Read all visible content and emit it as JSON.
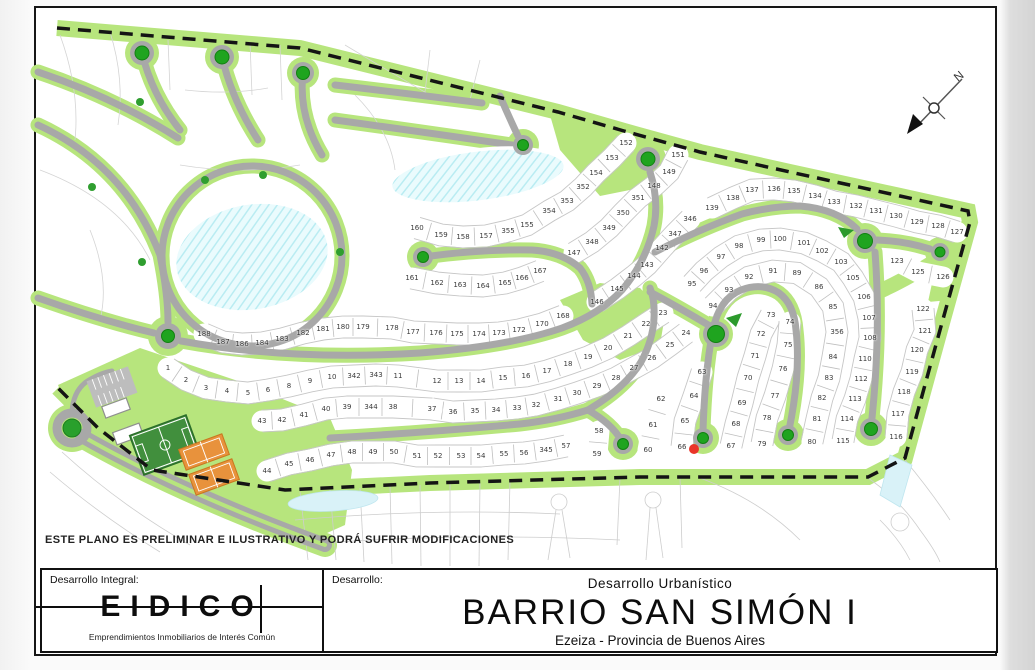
{
  "disclaimer": "ESTE PLANO ES PRELIMINAR E ILUSTRATIVO Y PODRÁ SUFRIR MODIFICACIONES",
  "title_block": {
    "left_label": "Desarrollo Integral:",
    "logo_text": "EIDICO",
    "logo_subtitle": "Emprendimientos Inmobiliarios de Interés Común",
    "dev_label": "Desarrollo:",
    "dev_type": "Desarrollo  Urbanístico",
    "project_name": "BARRIO SAN SIMÓN I",
    "location": "Ezeiza - Provincia de Buenos Aires"
  },
  "map": {
    "north_label": "N",
    "red_dot": {
      "x": 694,
      "y": 449,
      "color": "#e93428"
    },
    "colors": {
      "green": "#b7e57d",
      "road": "#a8a8a8",
      "tree": "#1fa41f",
      "lake": "#eafbfd",
      "court_orange": "#e8923c",
      "field_green": "#418f3d"
    },
    "lots": [
      [
        "1",
        168,
        368
      ],
      [
        "2",
        186,
        380
      ],
      [
        "3",
        206,
        388
      ],
      [
        "4",
        227,
        391
      ],
      [
        "5",
        248,
        393
      ],
      [
        "6",
        268,
        390
      ],
      [
        "8",
        289,
        386
      ],
      [
        "9",
        310,
        381
      ],
      [
        "10",
        332,
        377
      ],
      [
        "342",
        354,
        376
      ],
      [
        "343",
        376,
        375
      ],
      [
        "11",
        398,
        376
      ],
      [
        "12",
        437,
        381
      ],
      [
        "13",
        459,
        381
      ],
      [
        "14",
        481,
        381
      ],
      [
        "15",
        503,
        378
      ],
      [
        "16",
        526,
        376
      ],
      [
        "17",
        547,
        371
      ],
      [
        "18",
        568,
        364
      ],
      [
        "19",
        588,
        357
      ],
      [
        "20",
        608,
        348
      ],
      [
        "21",
        628,
        336
      ],
      [
        "22",
        646,
        324
      ],
      [
        "23",
        663,
        313
      ],
      [
        "24",
        686,
        333
      ],
      [
        "25",
        670,
        345
      ],
      [
        "26",
        652,
        358
      ],
      [
        "27",
        634,
        368
      ],
      [
        "28",
        616,
        378
      ],
      [
        "29",
        597,
        386
      ],
      [
        "30",
        577,
        393
      ],
      [
        "31",
        558,
        399
      ],
      [
        "32",
        536,
        405
      ],
      [
        "33",
        517,
        408
      ],
      [
        "34",
        496,
        410
      ],
      [
        "35",
        475,
        411
      ],
      [
        "36",
        453,
        412
      ],
      [
        "37",
        432,
        409
      ],
      [
        "38",
        393,
        407
      ],
      [
        "344",
        371,
        407
      ],
      [
        "39",
        347,
        407
      ],
      [
        "40",
        326,
        409
      ],
      [
        "41",
        304,
        415
      ],
      [
        "42",
        282,
        420
      ],
      [
        "43",
        262,
        421
      ],
      [
        "44",
        267,
        471
      ],
      [
        "45",
        289,
        464
      ],
      [
        "46",
        310,
        460
      ],
      [
        "47",
        331,
        455
      ],
      [
        "48",
        352,
        452
      ],
      [
        "49",
        373,
        452
      ],
      [
        "50",
        394,
        452
      ],
      [
        "51",
        417,
        456
      ],
      [
        "52",
        438,
        456
      ],
      [
        "53",
        461,
        456
      ],
      [
        "54",
        481,
        456
      ],
      [
        "55",
        504,
        454
      ],
      [
        "56",
        524,
        453
      ],
      [
        "345",
        546,
        450
      ],
      [
        "57",
        566,
        446
      ],
      [
        "58",
        599,
        431
      ],
      [
        "59",
        597,
        454
      ],
      [
        "60",
        648,
        450
      ],
      [
        "61",
        653,
        425
      ],
      [
        "62",
        661,
        399
      ],
      [
        "63",
        702,
        372
      ],
      [
        "64",
        694,
        396
      ],
      [
        "65",
        685,
        421
      ],
      [
        "66",
        682,
        447
      ],
      [
        "67",
        731,
        446
      ],
      [
        "68",
        736,
        424
      ],
      [
        "69",
        742,
        403
      ],
      [
        "70",
        748,
        378
      ],
      [
        "71",
        755,
        356
      ],
      [
        "72",
        761,
        334
      ],
      [
        "73",
        771,
        315
      ],
      [
        "74",
        790,
        322
      ],
      [
        "75",
        788,
        345
      ],
      [
        "76",
        783,
        369
      ],
      [
        "77",
        775,
        396
      ],
      [
        "78",
        767,
        418
      ],
      [
        "79",
        762,
        444
      ],
      [
        "80",
        812,
        442
      ],
      [
        "81",
        817,
        419
      ],
      [
        "82",
        822,
        398
      ],
      [
        "83",
        829,
        378
      ],
      [
        "84",
        833,
        357
      ],
      [
        "85",
        833,
        307
      ],
      [
        "86",
        819,
        287
      ],
      [
        "89",
        797,
        273
      ],
      [
        "91",
        773,
        271
      ],
      [
        "92",
        749,
        277
      ],
      [
        "93",
        729,
        290
      ],
      [
        "94",
        713,
        306
      ],
      [
        "95",
        692,
        284
      ],
      [
        "96",
        704,
        271
      ],
      [
        "97",
        721,
        257
      ],
      [
        "98",
        739,
        246
      ],
      [
        "99",
        761,
        240
      ],
      [
        "100",
        780,
        239
      ],
      [
        "101",
        804,
        243
      ],
      [
        "102",
        822,
        251
      ],
      [
        "103",
        841,
        262
      ],
      [
        "105",
        853,
        278
      ],
      [
        "106",
        864,
        297
      ],
      [
        "107",
        869,
        318
      ],
      [
        "108",
        870,
        338
      ],
      [
        "110",
        865,
        359
      ],
      [
        "112",
        861,
        379
      ],
      [
        "113",
        855,
        399
      ],
      [
        "114",
        847,
        419
      ],
      [
        "115",
        843,
        441
      ],
      [
        "116",
        896,
        437
      ],
      [
        "117",
        898,
        414
      ],
      [
        "118",
        904,
        392
      ],
      [
        "119",
        912,
        372
      ],
      [
        "120",
        917,
        350
      ],
      [
        "121",
        925,
        331
      ],
      [
        "122",
        923,
        309
      ],
      [
        "123",
        897,
        261
      ],
      [
        "125",
        918,
        272
      ],
      [
        "126",
        943,
        277
      ],
      [
        "127",
        957,
        232
      ],
      [
        "128",
        938,
        226
      ],
      [
        "129",
        917,
        222
      ],
      [
        "130",
        896,
        216
      ],
      [
        "131",
        876,
        211
      ],
      [
        "132",
        856,
        206
      ],
      [
        "133",
        834,
        202
      ],
      [
        "134",
        815,
        196
      ],
      [
        "135",
        794,
        191
      ],
      [
        "136",
        774,
        189
      ],
      [
        "137",
        752,
        190
      ],
      [
        "138",
        733,
        198
      ],
      [
        "139",
        712,
        208
      ],
      [
        "142",
        662,
        248
      ],
      [
        "143",
        647,
        265
      ],
      [
        "144",
        634,
        276
      ],
      [
        "145",
        617,
        289
      ],
      [
        "146",
        597,
        302
      ],
      [
        "147",
        574,
        253
      ],
      [
        "148",
        654,
        186
      ],
      [
        "149",
        669,
        172
      ],
      [
        "151",
        678,
        155
      ],
      [
        "152",
        626,
        143
      ],
      [
        "153",
        612,
        158
      ],
      [
        "154",
        596,
        173
      ],
      [
        "155",
        527,
        225
      ],
      [
        "355",
        508,
        231
      ],
      [
        "157",
        486,
        236
      ],
      [
        "158",
        463,
        237
      ],
      [
        "159",
        441,
        235
      ],
      [
        "160",
        417,
        228
      ],
      [
        "161",
        412,
        278
      ],
      [
        "162",
        437,
        283
      ],
      [
        "163",
        460,
        285
      ],
      [
        "164",
        483,
        286
      ],
      [
        "165",
        505,
        283
      ],
      [
        "166",
        522,
        278
      ],
      [
        "167",
        540,
        271
      ],
      [
        "168",
        563,
        316
      ],
      [
        "170",
        542,
        324
      ],
      [
        "172",
        519,
        330
      ],
      [
        "173",
        499,
        333
      ],
      [
        "174",
        479,
        334
      ],
      [
        "175",
        457,
        334
      ],
      [
        "176",
        436,
        333
      ],
      [
        "177",
        413,
        332
      ],
      [
        "178",
        392,
        328
      ],
      [
        "179",
        363,
        327
      ],
      [
        "180",
        343,
        327
      ],
      [
        "181",
        323,
        329
      ],
      [
        "182",
        303,
        333
      ],
      [
        "183",
        282,
        339
      ],
      [
        "184",
        262,
        343
      ],
      [
        "186",
        242,
        344
      ],
      [
        "187",
        223,
        342
      ],
      [
        "188",
        204,
        334
      ],
      [
        "346",
        690,
        219
      ],
      [
        "347",
        675,
        234
      ],
      [
        "348",
        592,
        242
      ],
      [
        "349",
        609,
        228
      ],
      [
        "350",
        623,
        213
      ],
      [
        "351",
        638,
        198
      ],
      [
        "352",
        583,
        187
      ],
      [
        "353",
        567,
        201
      ],
      [
        "354",
        549,
        211
      ],
      [
        "356",
        837,
        332
      ]
    ],
    "rows": [
      [
        "188",
        "187",
        "186",
        "184",
        "183",
        "182",
        "181",
        "180",
        "179",
        "178",
        "177",
        "176",
        "175",
        "174",
        "173",
        "172",
        "170",
        "168"
      ],
      [
        "1",
        "2",
        "3",
        "4",
        "5",
        "6",
        "8",
        "9",
        "10",
        "342",
        "343",
        "11",
        "12",
        "13",
        "14",
        "15",
        "16",
        "17",
        "18",
        "19",
        "20",
        "21",
        "22",
        "23"
      ],
      [
        "24",
        "25",
        "26",
        "27",
        "28",
        "29",
        "30",
        "31",
        "32",
        "33",
        "34",
        "35",
        "36",
        "37"
      ],
      [
        "43",
        "42",
        "41",
        "40",
        "39",
        "344",
        "38",
        "37"
      ],
      [
        "44",
        "45",
        "46",
        "47",
        "48",
        "49",
        "50",
        "51",
        "52",
        "53",
        "54",
        "55",
        "56",
        "345",
        "57"
      ],
      [
        "60",
        "61",
        "62"
      ],
      [
        "63",
        "64",
        "65",
        "66"
      ],
      [
        "67",
        "68",
        "69",
        "70",
        "71",
        "72",
        "73"
      ],
      [
        "74",
        "75",
        "76",
        "77",
        "78",
        "79"
      ],
      [
        "94",
        "93",
        "92",
        "91",
        "89",
        "86",
        "85",
        "356",
        "84",
        "83",
        "82",
        "81",
        "80"
      ],
      [
        "95",
        "96",
        "97",
        "98",
        "99",
        "100",
        "101",
        "102",
        "103",
        "105",
        "106",
        "107",
        "108",
        "110",
        "112",
        "113",
        "114",
        "115"
      ],
      [
        "116",
        "117",
        "118",
        "119",
        "120",
        "121",
        "122"
      ],
      [
        "123",
        "125",
        "126"
      ],
      [
        "127",
        "128",
        "129",
        "130",
        "131",
        "132",
        "133",
        "134",
        "135",
        "136",
        "137",
        "138",
        "139"
      ],
      [
        "346",
        "347",
        "142",
        "143",
        "144",
        "145",
        "146"
      ],
      [
        "147",
        "348",
        "349",
        "350",
        "351",
        "148",
        "149",
        "151"
      ],
      [
        "160",
        "159",
        "158",
        "157",
        "355",
        "155",
        "354",
        "353",
        "352",
        "154",
        "153",
        "152"
      ],
      [
        "161",
        "162",
        "163",
        "164",
        "165",
        "166",
        "167"
      ],
      [
        "58",
        "59"
      ]
    ]
  }
}
